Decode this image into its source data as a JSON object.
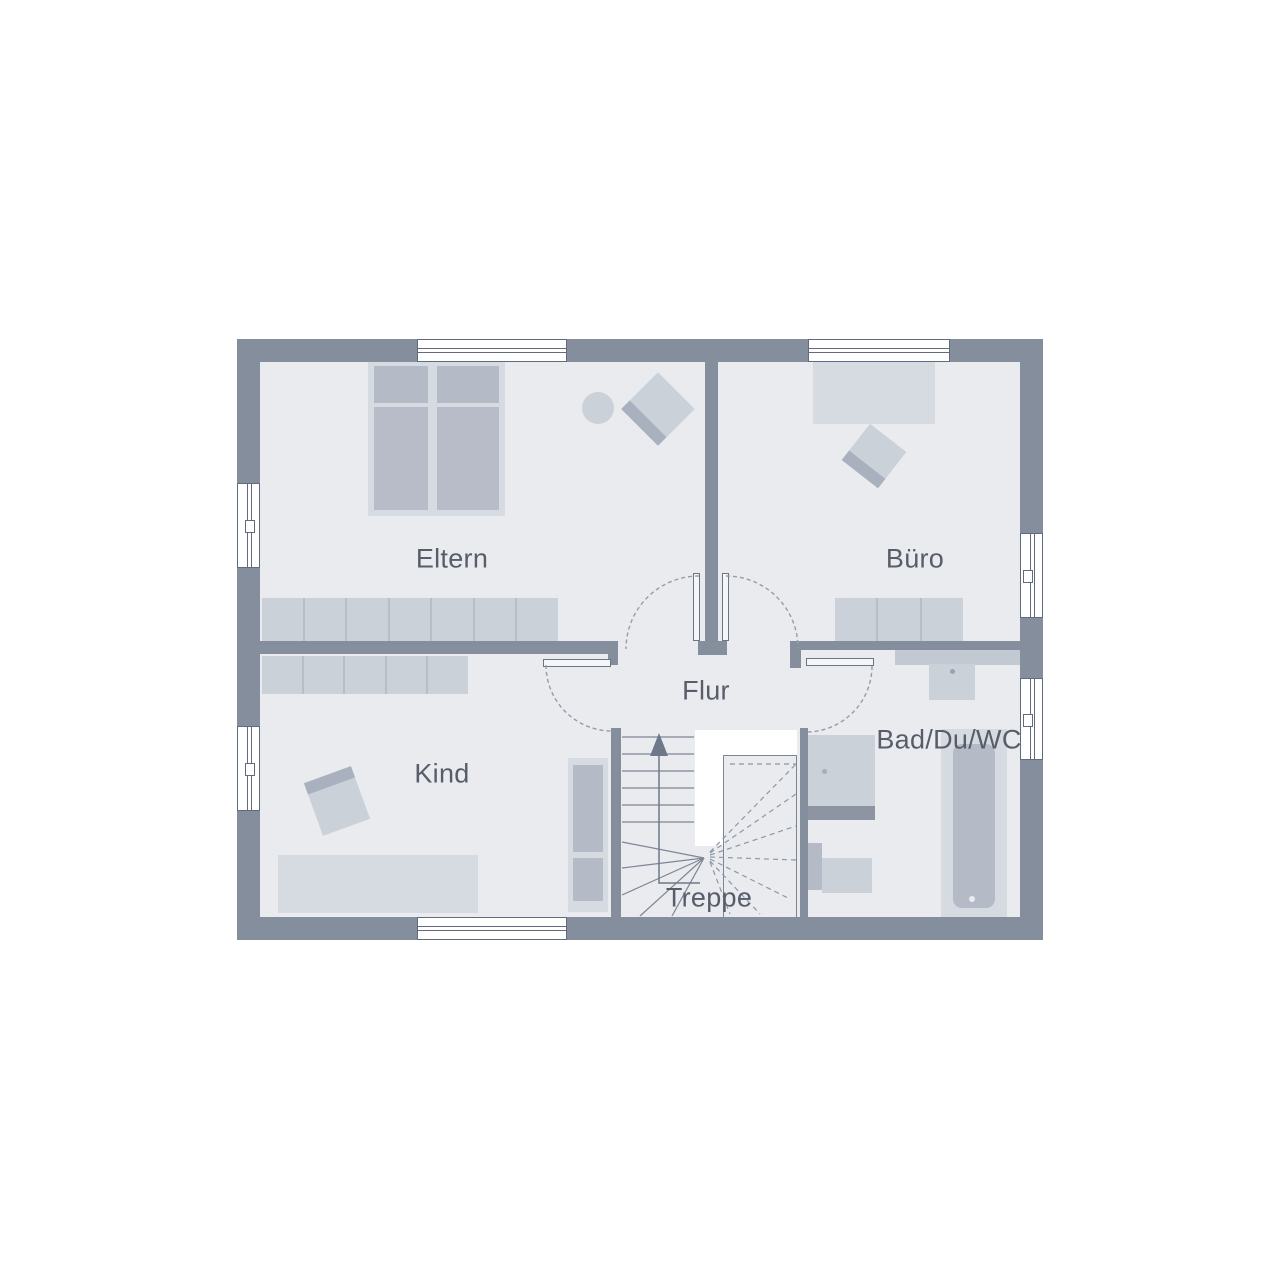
{
  "title": "Obergeschoss Grundriss",
  "rooms": [
    {
      "id": "eltern",
      "label": "Eltern",
      "furniture": [
        "double-bed",
        "bedside-table",
        "armchair",
        "wardrobe"
      ]
    },
    {
      "id": "buero",
      "label": "Büro",
      "furniture": [
        "desk",
        "office-chair",
        "sideboard"
      ]
    },
    {
      "id": "flur",
      "label": "Flur",
      "furniture": []
    },
    {
      "id": "kind",
      "label": "Kind",
      "furniture": [
        "wardrobe",
        "desk",
        "chair",
        "single-bed"
      ]
    },
    {
      "id": "bad",
      "label": "Bad/Du/WC",
      "furniture": [
        "sink",
        "shower",
        "toilet",
        "bathtub"
      ]
    },
    {
      "id": "treppe",
      "label": "Treppe",
      "furniture": [
        "winder-staircase",
        "up-arrow"
      ]
    }
  ],
  "colors": {
    "wall": "#858e9c",
    "floor": "#e9ebef",
    "furniture_light": "#d6dae1",
    "furniture_mid": "#cbd1d9",
    "furniture_dark": "#b4bac6",
    "stair_line": "#7d8695",
    "door_swing_dash": "#949dab",
    "label_text": "#575d69",
    "window_frame": "#606b7b"
  }
}
